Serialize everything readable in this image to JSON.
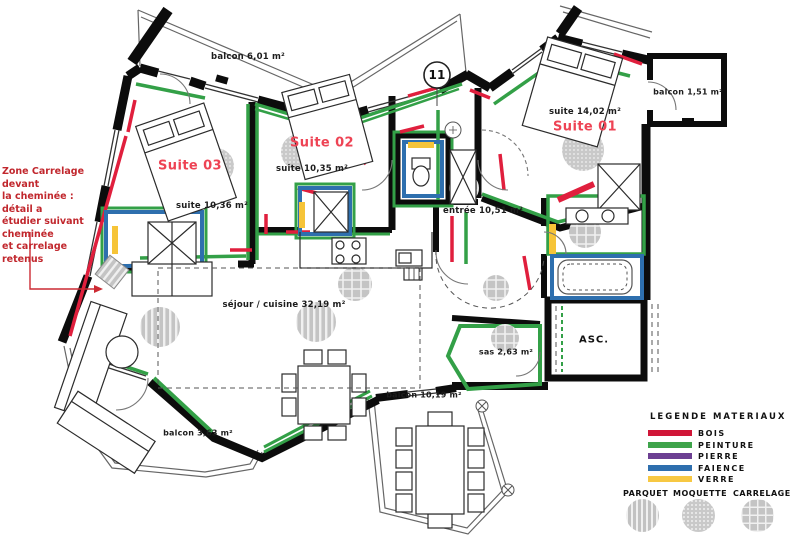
{
  "plan": {
    "marker_label": "11",
    "annotation": "Zone Carrelage devant\nla cheminée : détail a\nétudier suivant cheminée\net carrelage retenus",
    "labels": {
      "balcon_top": "balcon 6,01 m²",
      "balcon_right": "balcon 1,51 m²",
      "balcon_bottom_left": "balcon 3,63 m²",
      "balcon_terrace": "balcon 10,19 m²",
      "suite1_title": "Suite 01",
      "suite1_area": "suite 14,02 m²",
      "suite2_title": "Suite 02",
      "suite2_area": "suite 10,35 m²",
      "suite3_title": "Suite 03",
      "suite3_area": "suite 10,36 m²",
      "entree": "entrée 10,51 m²",
      "sejour": "séjour / cuisine 32,19 m²",
      "sas": "sas 2,63 m²",
      "asc": "ASC."
    }
  },
  "legend": {
    "title": "LEGENDE MATERIAUX",
    "materials": [
      {
        "label": "BOIS",
        "color": "#d01638"
      },
      {
        "label": "PEINTURE",
        "color": "#3ea44b"
      },
      {
        "label": "PIERRE",
        "color": "#6c3f92"
      },
      {
        "label": "FAIENCE",
        "color": "#2e6fae"
      },
      {
        "label": "VERRE",
        "color": "#f7c843"
      }
    ],
    "floor_finishes": [
      {
        "label": "PARQUET",
        "pattern": "vertical-stripes"
      },
      {
        "label": "MOQUETTE",
        "pattern": "dots"
      },
      {
        "label": "CARRELAGE",
        "pattern": "grid"
      }
    ]
  }
}
